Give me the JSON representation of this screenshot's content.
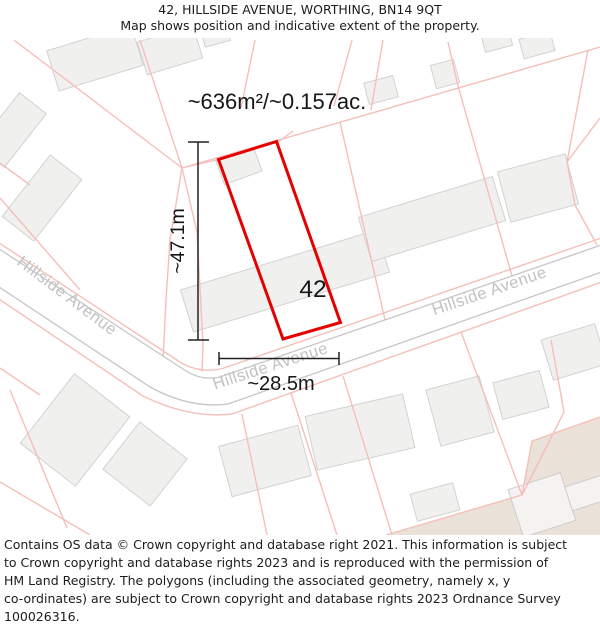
{
  "header": {
    "title": "42, HILLSIDE AVENUE, WORTHING, BN14 9QT",
    "subtitle": "Map shows position and indicative extent of the property."
  },
  "map": {
    "area_label": "~636m²/~0.157ac.",
    "plot_number": "42",
    "width_label": "~28.5m",
    "height_label": "~47.1m",
    "street_label": "Hillside Avenue",
    "colors": {
      "property_outline": "#e60000",
      "parcel_line": "#f5bfb9",
      "road_edge": "#c6c6c6",
      "building_fill": "#f0f0ee",
      "terrain_fill": "#eae1d8",
      "street_label_text": "#c2c2c2",
      "annotation_text": "#161616"
    }
  },
  "footer": {
    "lines": [
      "Contains OS data © Crown copyright and database right 2021. This information is subject",
      "to Crown copyright and database rights 2023 and is reproduced with the permission of",
      "HM Land Registry. The polygons (including the associated geometry, namely x, y",
      "co-ordinates) are subject to Crown copyright and database rights 2023 Ordnance Survey",
      "100026316."
    ]
  }
}
